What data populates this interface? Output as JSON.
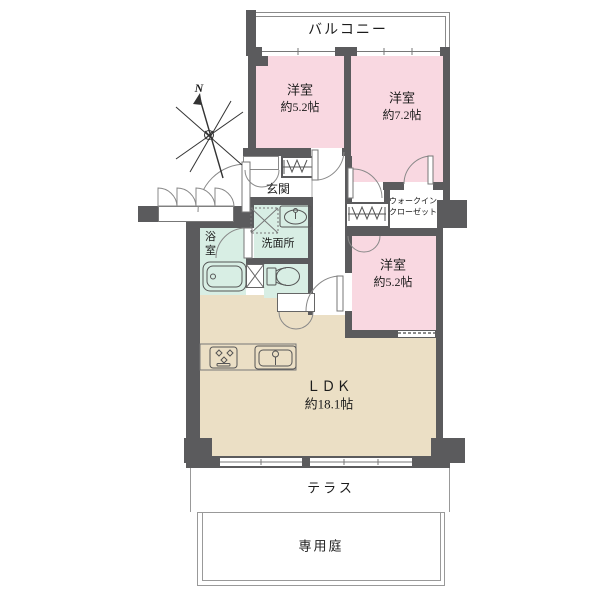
{
  "colors": {
    "wall": "#5b5b5d",
    "bedroom_fill": "#f9d8e1",
    "wet_area_fill": "#d8eee4",
    "ldk_fill": "#ebdfc5",
    "outline": "#8a8a8a"
  },
  "compass": {
    "north": "N"
  },
  "balcony": {
    "label": "バルコニー"
  },
  "rooms": {
    "bedroom1": {
      "name": "洋室",
      "size": "約5.2帖"
    },
    "bedroom2": {
      "name": "洋室",
      "size": "約7.2帖"
    },
    "bedroom3": {
      "name": "洋室",
      "size": "約5.2帖"
    },
    "ldk": {
      "name": "ＬＤＫ",
      "size": "約18.1帖"
    },
    "entrance": {
      "label": "玄関"
    },
    "bathroom": {
      "label": "浴室"
    },
    "washroom": {
      "label": "洗面所"
    },
    "walk_in_closet": {
      "line1": "ウォークイン",
      "line2": "クローゼット"
    }
  },
  "outdoor": {
    "terrace": {
      "label": "テラス"
    },
    "garden": {
      "label": "専用庭"
    }
  },
  "icons": [
    "north-compass-icon",
    "bathtub-icon",
    "toilet-icon",
    "vanity-sink-icon",
    "washing-machine-pan-icon",
    "pipe-space-icon",
    "stove-icon",
    "kitchen-sink-icon",
    "hanger-pipe-icon",
    "door-swing-icon",
    "folding-door-icon",
    "bifold-door-icon",
    "window-icon"
  ]
}
